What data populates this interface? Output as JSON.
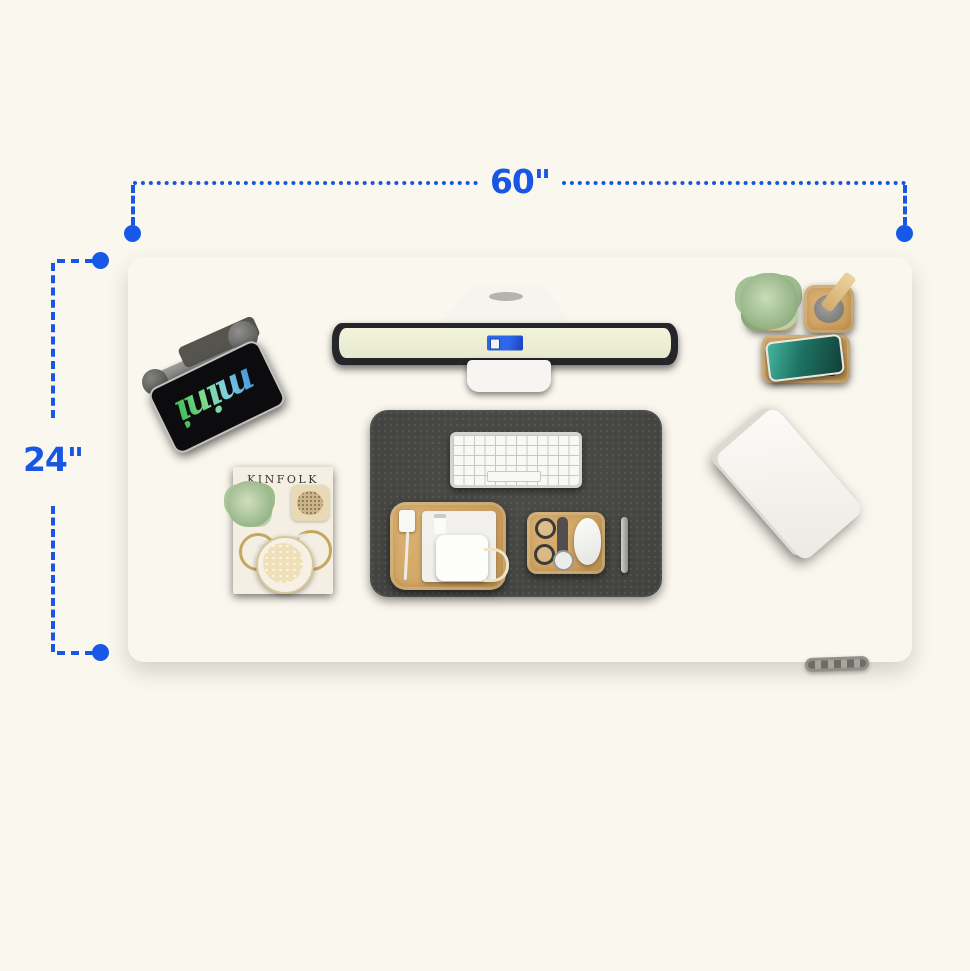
{
  "scene": {
    "description": "Top-down product diagram of a black standing desk with accessories and blue dimension annotations",
    "background_color": "#faf7ee",
    "desk_color": "#232322"
  },
  "dimension_annotations": {
    "color": "#1856e3",
    "width": {
      "label": "60\""
    },
    "depth": {
      "label": "24\""
    }
  },
  "desk_items": {
    "tablet": {
      "screen_text": "mini",
      "description": "iPad mini on gray clamp stand"
    },
    "monitor": {
      "description": "white monitor seen from above, pale screen with blue logo"
    },
    "planter": {
      "description": "wooden pot with green succulent"
    },
    "pen_holder": {
      "description": "wooden cup with wooden stylus"
    },
    "wireless_charger": {
      "description": "wooden charging stand with teal-screen phone"
    },
    "desk_mat": {
      "description": "dark gray felt mat"
    },
    "keyboard": {
      "description": "white compact keyboard"
    },
    "cable_tray": {
      "description": "bamboo tray with white adapter, charger and cables"
    },
    "accessory_tray": {
      "description": "bamboo tray with glasses, watch and white mouse"
    },
    "pen": {
      "description": "silver pen"
    },
    "magazine": {
      "title": "KINFOLK",
      "description": "magazine with plant, dish, bicycle photo and latte cup"
    },
    "laptop": {
      "description": "closed white laptop rotated on desk"
    },
    "controller": {
      "description": "desk height controller keypad on front edge"
    }
  }
}
